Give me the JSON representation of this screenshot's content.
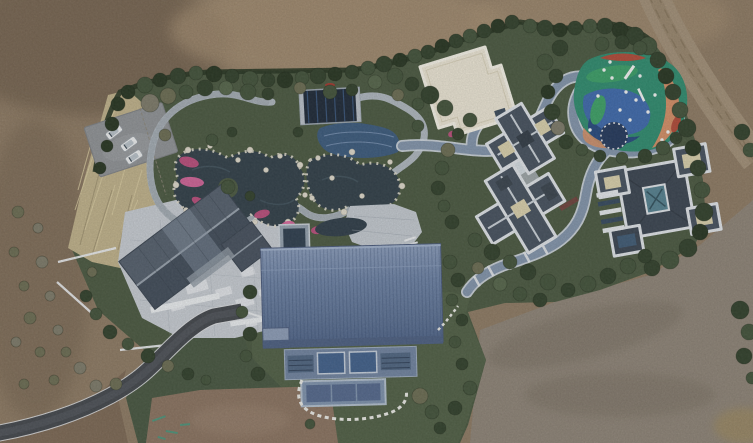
{
  "scene": {
    "kind": "aerial-drone-photograph",
    "subject": "landscaped private estate compound surrounded by bare earth",
    "features": [
      "dirt-field",
      "hedge-boundary",
      "parking-area",
      "dry-grass",
      "garden-pond",
      "stone-paths",
      "dark-pavilion",
      "white-flat-roof-building",
      "playground",
      "blue-walkway",
      "villa-1",
      "villa-2",
      "gabled-house",
      "paved-courtyard",
      "blue-metal-barn",
      "asphalt-driveway",
      "dirt-road"
    ]
  },
  "palette": {
    "dirt_base": "#8d7a63",
    "dirt_dark": "#705e4c",
    "dirt_light": "#a68f72",
    "dirt_gray": "#8d8376",
    "dirt_patch": "#8a7360",
    "dirt_corner": "#7c6854",
    "road_dirt": "#a18f77",
    "asphalt": "#43474c",
    "asphalt_edge": "#d9dcde",
    "garden_green": "#4a5840",
    "lawn": "#505f45",
    "lawn_dark": "#475640",
    "hedge": "#273521",
    "shrub_dark": "#31402b",
    "shrub_mid": "#42523a",
    "shrub_light": "#55654a",
    "shrub_olive": "#6b6c52",
    "shrub_gray": "#7d7a69",
    "grass_dry": "#bfb18a",
    "pavement": "#c6cbd1",
    "stone_path": "#aeb6bd",
    "walkway_blue": "#8294aa",
    "walkway_curb": "#cdd5dd",
    "pond": "#313f48",
    "pond_light": "#44555f",
    "pool_blue": "#3b5a7c",
    "pavilion_dark": "#1e2937",
    "pavilion_stripe": "#3c5a82",
    "white_roof": "#eae4d3",
    "white_roof_edge": "#f4f1e6",
    "villa_slate": "#46515e",
    "villa_slate_dark": "#3a4450",
    "villa_fascia": "#dfe3e7",
    "villa_cream": "#d8cfab",
    "villa_teal": "#55808f",
    "house_roof": "#4a5562",
    "barn_eave": "#4c5f81",
    "barn_wall": "#70839f",
    "barn_glass": "#41608a",
    "car_white": "#eceeef",
    "rock_white": "#ddd8ca",
    "flower_a": "#c04f7e",
    "flower_b": "#d7659b",
    "flower_red": "#a8392f",
    "play_teal": "#2f8b6e",
    "play_blue": "#3e69ab",
    "play_navy": "#27497e",
    "play_orange": "#d28e66",
    "play_red": "#b04a38",
    "play_green": "#3da066",
    "paint_teal": "#3f9a80"
  },
  "bushes": [
    [
      100,
      168,
      6,
      "hedge"
    ],
    [
      107,
      146,
      6,
      "hedge"
    ],
    [
      112,
      124,
      7,
      "hedge"
    ],
    [
      118,
      104,
      7,
      "hedge"
    ],
    [
      128,
      92,
      7,
      "hedge"
    ],
    [
      145,
      85,
      8,
      "shrub_mid"
    ],
    [
      160,
      80,
      7,
      "hedge"
    ],
    [
      178,
      76,
      8,
      "shrub_dark"
    ],
    [
      196,
      73,
      7,
      "shrub_mid"
    ],
    [
      214,
      74,
      8,
      "hedge"
    ],
    [
      232,
      76,
      7,
      "shrub_dark"
    ],
    [
      250,
      79,
      8,
      "shrub_mid"
    ],
    [
      268,
      80,
      7,
      "shrub_dark"
    ],
    [
      285,
      80,
      8,
      "hedge"
    ],
    [
      302,
      78,
      7,
      "shrub_mid"
    ],
    [
      318,
      76,
      8,
      "shrub_dark"
    ],
    [
      335,
      74,
      7,
      "hedge"
    ],
    [
      352,
      72,
      7,
      "shrub_dark"
    ],
    [
      368,
      68,
      7,
      "shrub_mid"
    ],
    [
      384,
      64,
      8,
      "shrub_dark"
    ],
    [
      400,
      60,
      7,
      "hedge"
    ],
    [
      415,
      56,
      7,
      "shrub_mid"
    ],
    [
      428,
      52,
      7,
      "shrub_dark"
    ],
    [
      442,
      46,
      7,
      "hedge"
    ],
    [
      456,
      41,
      7,
      "shrub_dark"
    ],
    [
      470,
      36,
      7,
      "shrub_mid"
    ],
    [
      484,
      31,
      7,
      "shrub_dark"
    ],
    [
      498,
      26,
      7,
      "hedge"
    ],
    [
      512,
      22,
      7,
      "shrub_dark"
    ],
    [
      150,
      103,
      9,
      "shrub_gray"
    ],
    [
      168,
      96,
      8,
      "shrub_olive"
    ],
    [
      186,
      92,
      7,
      "shrub_mid"
    ],
    [
      205,
      88,
      8,
      "shrub_dark"
    ],
    [
      226,
      88,
      7,
      "shrub_light"
    ],
    [
      248,
      92,
      8,
      "shrub_mid"
    ],
    [
      268,
      94,
      6,
      "shrub_dark"
    ],
    [
      300,
      88,
      6,
      "shrub_olive"
    ],
    [
      330,
      92,
      7,
      "shrub_mid"
    ],
    [
      352,
      90,
      6,
      "shrub_dark"
    ],
    [
      375,
      82,
      7,
      "shrub_light"
    ],
    [
      395,
      76,
      8,
      "shrub_mid"
    ],
    [
      412,
      84,
      7,
      "shrub_dark"
    ],
    [
      398,
      95,
      6,
      "shrub_olive"
    ],
    [
      430,
      95,
      9,
      "shrub_dark"
    ],
    [
      445,
      108,
      8,
      "shrub_mid"
    ],
    [
      418,
      104,
      6,
      "shrub_mid"
    ],
    [
      212,
      140,
      6,
      "shrub_mid"
    ],
    [
      232,
      132,
      5,
      "shrub_dark"
    ],
    [
      165,
      135,
      6,
      "shrub_olive"
    ],
    [
      298,
      132,
      5,
      "shrub_dark"
    ],
    [
      418,
      126,
      6,
      "shrub_mid"
    ],
    [
      530,
      26,
      7,
      "shrub_mid"
    ],
    [
      545,
      28,
      8,
      "shrub_dark"
    ],
    [
      560,
      30,
      7,
      "hedge"
    ],
    [
      575,
      28,
      7,
      "shrub_dark"
    ],
    [
      590,
      26,
      7,
      "shrub_mid"
    ],
    [
      605,
      26,
      8,
      "shrub_dark"
    ],
    [
      620,
      30,
      8,
      "hedge"
    ],
    [
      635,
      36,
      9,
      "shrub_dark"
    ],
    [
      648,
      46,
      9,
      "shrub_mid"
    ],
    [
      658,
      60,
      8,
      "shrub_dark"
    ],
    [
      666,
      76,
      8,
      "hedge"
    ],
    [
      673,
      92,
      8,
      "shrub_dark"
    ],
    [
      680,
      110,
      8,
      "shrub_mid"
    ],
    [
      687,
      128,
      9,
      "shrub_dark"
    ],
    [
      693,
      148,
      8,
      "hedge"
    ],
    [
      698,
      168,
      8,
      "shrub_dark"
    ],
    [
      702,
      190,
      8,
      "shrub_mid"
    ],
    [
      704,
      212,
      9,
      "shrub_dark"
    ],
    [
      700,
      232,
      8,
      "hedge"
    ],
    [
      688,
      248,
      9,
      "shrub_dark"
    ],
    [
      670,
      260,
      9,
      "shrub_mid"
    ],
    [
      652,
      268,
      8,
      "shrub_dark"
    ],
    [
      560,
      48,
      8,
      "shrub_dark"
    ],
    [
      545,
      62,
      8,
      "shrub_mid"
    ],
    [
      556,
      76,
      7,
      "shrub_dark"
    ],
    [
      548,
      92,
      7,
      "hedge"
    ],
    [
      552,
      112,
      8,
      "shrub_dark"
    ],
    [
      558,
      128,
      7,
      "shrub_gray"
    ],
    [
      566,
      142,
      7,
      "shrub_dark"
    ],
    [
      582,
      150,
      6,
      "shrub_mid"
    ],
    [
      600,
      156,
      6,
      "shrub_dark"
    ],
    [
      622,
      158,
      6,
      "shrub_mid"
    ],
    [
      645,
      156,
      7,
      "shrub_dark"
    ],
    [
      663,
      148,
      7,
      "shrub_mid"
    ],
    [
      676,
      138,
      6,
      "shrub_dark"
    ],
    [
      602,
      44,
      7,
      "shrub_mid"
    ],
    [
      622,
      42,
      7,
      "shrub_dark"
    ],
    [
      640,
      48,
      7,
      "shrub_mid"
    ],
    [
      470,
      120,
      7,
      "shrub_mid"
    ],
    [
      458,
      134,
      6,
      "shrub_dark"
    ],
    [
      448,
      150,
      7,
      "shrub_olive"
    ],
    [
      442,
      168,
      7,
      "shrub_mid"
    ],
    [
      438,
      188,
      7,
      "shrub_dark"
    ],
    [
      444,
      206,
      6,
      "shrub_mid"
    ],
    [
      452,
      222,
      7,
      "shrub_dark"
    ],
    [
      475,
      240,
      7,
      "shrub_mid"
    ],
    [
      492,
      252,
      8,
      "shrub_dark"
    ],
    [
      510,
      262,
      7,
      "shrub_mid"
    ],
    [
      528,
      272,
      8,
      "shrub_dark"
    ],
    [
      548,
      282,
      8,
      "shrub_mid"
    ],
    [
      568,
      290,
      7,
      "shrub_dark"
    ],
    [
      588,
      284,
      8,
      "shrub_mid"
    ],
    [
      608,
      276,
      8,
      "shrub_dark"
    ],
    [
      628,
      266,
      8,
      "shrub_mid"
    ],
    [
      645,
      256,
      7,
      "shrub_dark"
    ],
    [
      500,
      284,
      7,
      "shrub_light"
    ],
    [
      520,
      294,
      7,
      "shrub_mid"
    ],
    [
      540,
      300,
      7,
      "shrub_dark"
    ],
    [
      478,
      268,
      6,
      "shrub_olive"
    ],
    [
      250,
      292,
      7,
      "shrub_dark"
    ],
    [
      242,
      312,
      6,
      "shrub_mid"
    ],
    [
      250,
      334,
      7,
      "shrub_dark"
    ],
    [
      246,
      356,
      6,
      "shrub_mid"
    ],
    [
      258,
      374,
      7,
      "shrub_dark"
    ],
    [
      450,
      262,
      7,
      "shrub_mid"
    ],
    [
      458,
      280,
      7,
      "shrub_dark"
    ],
    [
      452,
      300,
      6,
      "shrub_mid"
    ],
    [
      462,
      320,
      6,
      "shrub_dark"
    ],
    [
      455,
      342,
      6,
      "shrub_mid"
    ],
    [
      462,
      364,
      6,
      "shrub_dark"
    ],
    [
      470,
      388,
      7,
      "shrub_mid"
    ],
    [
      455,
      408,
      7,
      "shrub_dark"
    ],
    [
      420,
      396,
      8,
      "shrub_olive"
    ],
    [
      432,
      412,
      7,
      "shrub_mid"
    ],
    [
      440,
      428,
      6,
      "shrub_dark"
    ],
    [
      310,
      424,
      5,
      "shrub_mid"
    ],
    [
      110,
      332,
      7,
      "shrub_dark"
    ],
    [
      128,
      344,
      6,
      "shrub_mid"
    ],
    [
      148,
      356,
      7,
      "shrub_dark"
    ],
    [
      168,
      366,
      6,
      "shrub_olive"
    ],
    [
      188,
      374,
      6,
      "shrub_dark"
    ],
    [
      206,
      380,
      5,
      "shrub_mid"
    ],
    [
      96,
      314,
      6,
      "shrub_mid"
    ],
    [
      86,
      296,
      6,
      "shrub_dark"
    ],
    [
      92,
      272,
      5,
      "shrub_olive"
    ],
    [
      18,
      212,
      6,
      "shrub_olive"
    ],
    [
      38,
      228,
      5,
      "shrub_gray"
    ],
    [
      14,
      252,
      5,
      "shrub_olive"
    ],
    [
      42,
      262,
      6,
      "shrub_gray"
    ],
    [
      24,
      286,
      5,
      "shrub_olive"
    ],
    [
      50,
      296,
      5,
      "shrub_gray"
    ],
    [
      30,
      318,
      6,
      "shrub_olive"
    ],
    [
      58,
      330,
      5,
      "shrub_gray"
    ],
    [
      40,
      352,
      5,
      "shrub_olive"
    ],
    [
      16,
      342,
      5,
      "shrub_gray"
    ],
    [
      66,
      352,
      5,
      "shrub_olive"
    ],
    [
      80,
      368,
      6,
      "shrub_gray"
    ],
    [
      54,
      380,
      5,
      "shrub_olive"
    ],
    [
      24,
      384,
      5,
      "shrub_olive"
    ],
    [
      96,
      386,
      6,
      "shrub_gray"
    ],
    [
      116,
      384,
      6,
      "shrub_olive"
    ],
    [
      742,
      132,
      8,
      "shrub_dark"
    ],
    [
      750,
      150,
      7,
      "shrub_mid"
    ],
    [
      740,
      310,
      9,
      "shrub_dark"
    ],
    [
      749,
      332,
      8,
      "shrub_mid"
    ],
    [
      744,
      356,
      8,
      "shrub_dark"
    ],
    [
      752,
      378,
      6,
      "shrub_mid"
    ],
    [
      228,
      187,
      7,
      "shrub_mid"
    ],
    [
      250,
      196,
      5,
      "shrub_dark"
    ]
  ],
  "cars": [
    {
      "x": 114,
      "y": 132,
      "rot": -38
    },
    {
      "x": 129,
      "y": 144,
      "rot": -36
    },
    {
      "x": 134,
      "y": 157,
      "rot": -33
    }
  ],
  "flowers": [
    [
      189,
      162,
      5,
      10,
      -75,
      "flower_a"
    ],
    [
      192,
      182,
      5,
      12,
      -85,
      "flower_b"
    ],
    [
      199,
      202,
      4,
      8,
      -60,
      "flower_a"
    ],
    [
      262,
      214,
      8,
      4,
      -15,
      "flower_a"
    ],
    [
      288,
      225,
      7,
      4,
      -10,
      "flower_b"
    ],
    [
      318,
      230,
      7,
      4,
      -8,
      "flower_a"
    ],
    [
      350,
      219,
      5,
      3,
      -5,
      "flower_b"
    ],
    [
      376,
      214,
      4,
      3,
      0,
      "flower_a"
    ],
    [
      410,
      228,
      5,
      3,
      -20,
      "flower_b"
    ],
    [
      502,
      104,
      7,
      3,
      -17,
      "flower_red"
    ],
    [
      330,
      85,
      5,
      2,
      0,
      "flower_red"
    ],
    [
      452,
      134,
      4,
      3,
      -20,
      "flower_a"
    ]
  ],
  "rocks": [
    [
      188,
      150,
      3
    ],
    [
      210,
      146,
      2.5
    ],
    [
      250,
      150,
      3
    ],
    [
      280,
      156,
      2.5
    ],
    [
      300,
      165,
      3
    ],
    [
      305,
      195,
      2.5
    ],
    [
      288,
      222,
      3
    ],
    [
      255,
      222,
      2.5
    ],
    [
      215,
      222,
      3
    ],
    [
      186,
      210,
      2.5
    ],
    [
      176,
      185,
      3
    ],
    [
      318,
      158,
      2.5
    ],
    [
      352,
      152,
      3
    ],
    [
      390,
      162,
      2.5
    ],
    [
      402,
      186,
      3
    ],
    [
      388,
      210,
      2.5
    ],
    [
      344,
      212,
      3
    ],
    [
      312,
      198,
      2.5
    ],
    [
      238,
      160,
      2.5
    ],
    [
      266,
      170,
      2.5
    ],
    [
      332,
      178,
      2.5
    ],
    [
      362,
      196,
      2.5
    ]
  ],
  "paver_blobs": [
    [
      150,
      240,
      16,
      8
    ],
    [
      170,
      260,
      20,
      10
    ],
    [
      195,
      235,
      14,
      8
    ],
    [
      210,
      255,
      18,
      9
    ],
    [
      185,
      285,
      22,
      10
    ],
    [
      150,
      275,
      14,
      7
    ],
    [
      215,
      290,
      16,
      8
    ],
    [
      240,
      270,
      14,
      8
    ],
    [
      235,
      300,
      18,
      9
    ],
    [
      205,
      315,
      16,
      8
    ],
    [
      170,
      305,
      14,
      7
    ],
    [
      250,
      245,
      12,
      7
    ],
    [
      258,
      290,
      12,
      7
    ],
    [
      140,
      255,
      10,
      6
    ],
    [
      225,
      230,
      12,
      6
    ],
    [
      245,
      322,
      12,
      6
    ]
  ],
  "equipment_dots": [
    [
      604,
      70
    ],
    [
      612,
      78
    ],
    [
      626,
      92
    ],
    [
      636,
      100
    ],
    [
      648,
      112
    ],
    [
      655,
      95
    ],
    [
      640,
      76
    ],
    [
      620,
      110
    ],
    [
      598,
      96
    ],
    [
      668,
      132
    ],
    [
      662,
      140
    ],
    [
      590,
      130
    ],
    [
      630,
      120
    ],
    [
      610,
      62
    ]
  ],
  "paint_marks": [
    [
      152,
      420,
      14,
      -20
    ],
    [
      166,
      430,
      12,
      10
    ],
    [
      180,
      424,
      10,
      -5
    ],
    [
      158,
      436,
      8,
      15
    ]
  ],
  "grass_streaks": [
    [
      75,
      210,
      95,
      150
    ],
    [
      85,
      230,
      108,
      160
    ],
    [
      95,
      250,
      115,
      185
    ],
    [
      105,
      130,
      120,
      100
    ],
    [
      78,
      190,
      92,
      140
    ],
    [
      112,
      215,
      126,
      165
    ],
    [
      120,
      240,
      138,
      200
    ],
    [
      130,
      210,
      142,
      170
    ]
  ]
}
